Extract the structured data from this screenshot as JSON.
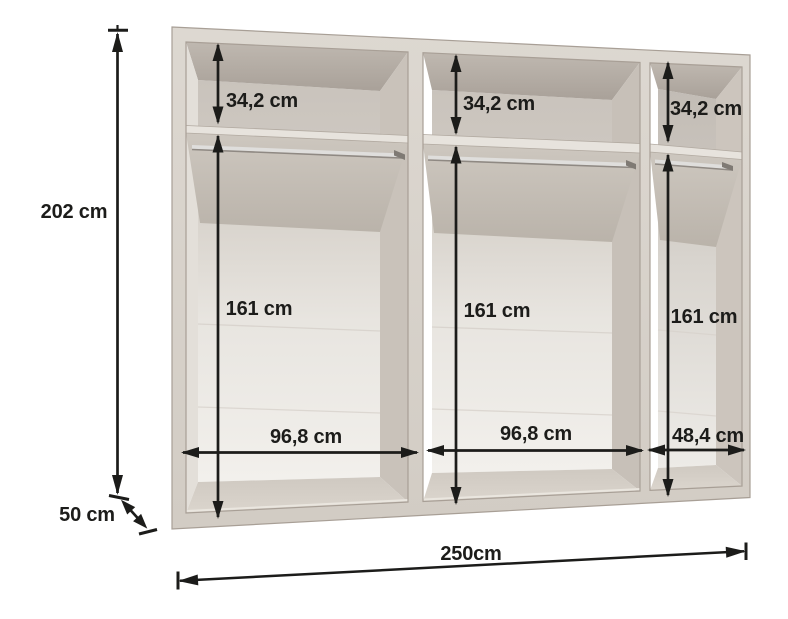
{
  "diagram": {
    "unit": "cm",
    "labels": {
      "total_height": "202 cm",
      "depth": "50 cm",
      "total_width": "250cm"
    },
    "compartments": [
      {
        "top_section_height": "34,2 cm",
        "hanging_height": "161 cm",
        "width": "96,8 cm"
      },
      {
        "top_section_height": "34,2 cm",
        "hanging_height": "161 cm",
        "width": "96,8 cm"
      },
      {
        "top_section_height": "34,2 cm",
        "hanging_height": "161 cm",
        "width": "48,4 cm"
      }
    ],
    "colors": {
      "frame": "#d9d3cc",
      "dimension_lines": "#1c1c1a",
      "background": "#ffffff"
    }
  }
}
